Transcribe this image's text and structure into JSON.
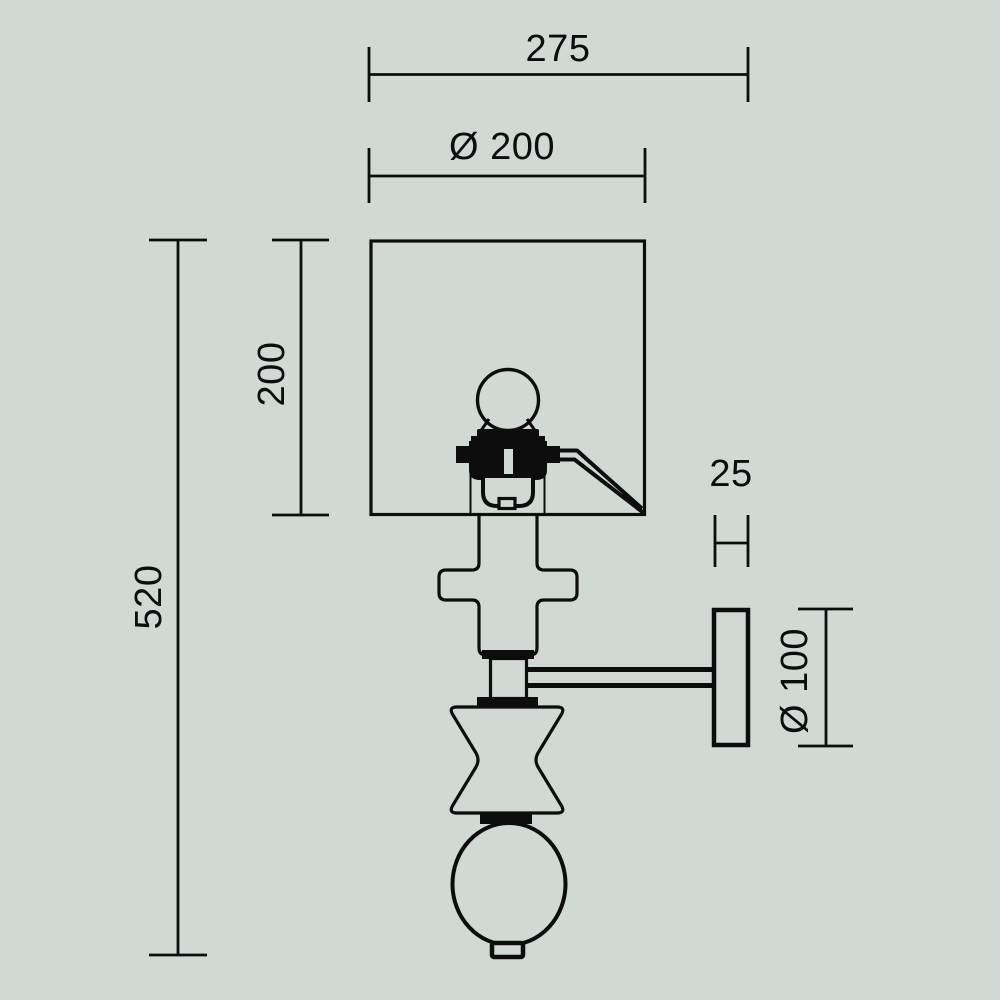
{
  "colors": {
    "background": "#d2d9d5",
    "line": "#0d0d0d"
  },
  "dims": {
    "overall_depth": "275",
    "shade_diameter": "Ø 200",
    "shade_height": "200",
    "overall_height": "520",
    "plate_thickness": "25",
    "plate_diameter": "Ø 100"
  }
}
